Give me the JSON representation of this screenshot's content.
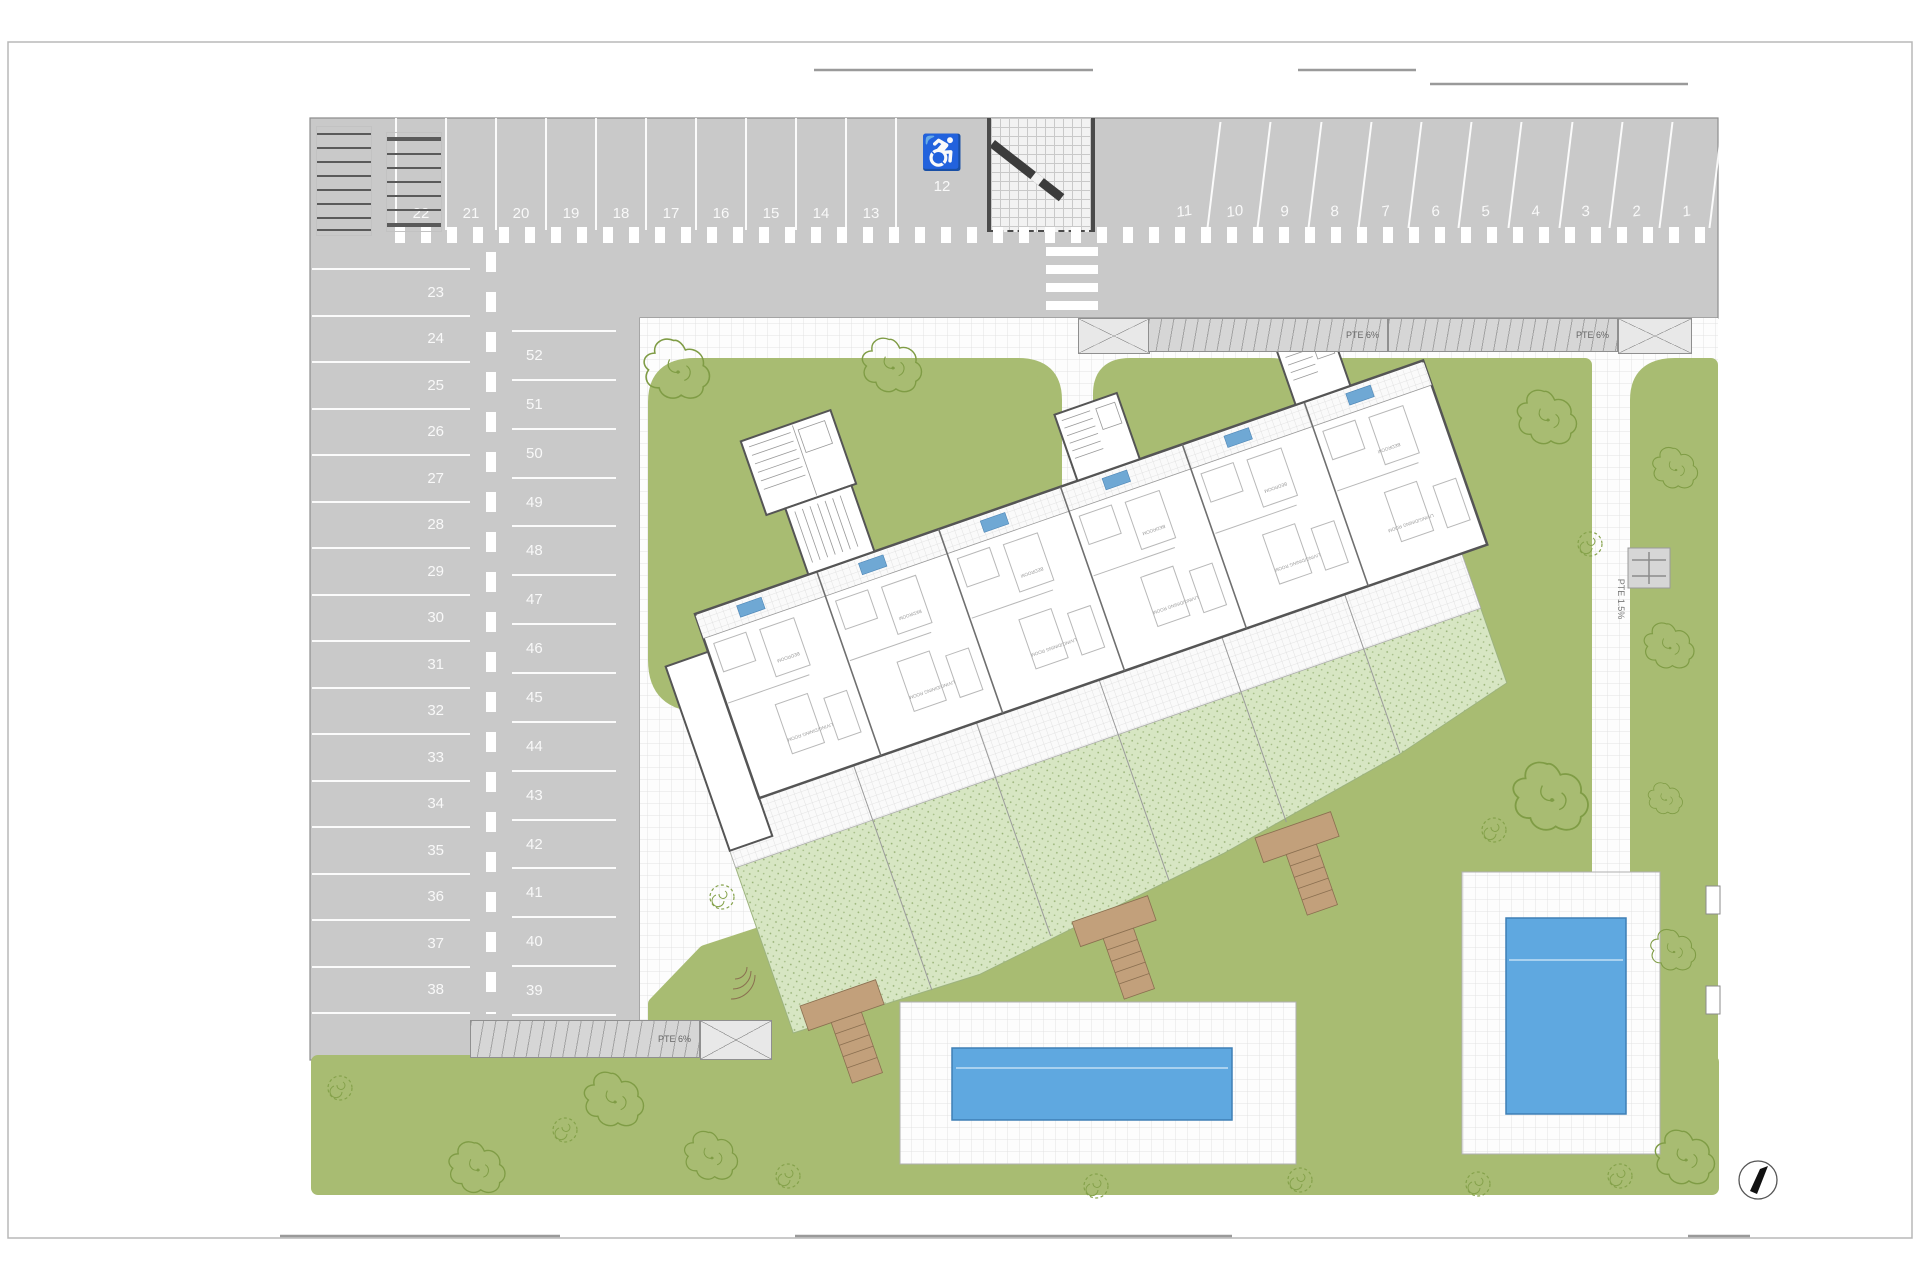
{
  "parking": {
    "rows": {
      "top_left": [
        "22",
        "21",
        "20",
        "19",
        "18",
        "17",
        "16",
        "15",
        "14",
        "13"
      ],
      "handicap": {
        "number": "12",
        "symbol": "♿"
      },
      "top_right": [
        "11",
        "10",
        "9",
        "8",
        "7",
        "6",
        "5",
        "4",
        "3",
        "2",
        "1"
      ],
      "left_column": [
        "23",
        "24",
        "25",
        "26",
        "27",
        "28",
        "29",
        "30",
        "31",
        "32",
        "33",
        "34",
        "35",
        "36",
        "37",
        "38"
      ],
      "middle_column": [
        "52",
        "51",
        "50",
        "49",
        "48",
        "47",
        "46",
        "45",
        "44",
        "43",
        "42",
        "41",
        "40",
        "39"
      ]
    }
  },
  "ramps": {
    "vehicle_slope_label": "PTE 6%",
    "path_slope_label": "PTE 1.5%"
  },
  "building": {
    "units": [
      {
        "bedroom_label": "BEDROOM",
        "living_label": "LIVING/DINING ROOM"
      },
      {
        "bedroom_label": "BEDROOM",
        "living_label": "LIVING/DINING ROOM"
      },
      {
        "bedroom_label": "BEDROOM",
        "living_label": "LIVING/DINING ROOM"
      },
      {
        "bedroom_label": "BEDROOM",
        "living_label": "LIVING/DINING ROOM"
      },
      {
        "bedroom_label": "BEDROOM",
        "living_label": "LIVING/DINING ROOM"
      },
      {
        "bedroom_label": "BEDROOM",
        "living_label": "LIVING/DINING ROOM"
      }
    ]
  },
  "colors": {
    "asphalt": "#c9c9c9",
    "lawn": "#a8bc72",
    "private_garden": "#d7e6c3",
    "pool_water": "#5fa8e0",
    "wood_walkway": "#c2a07b",
    "unit_badge": "#6fa8d4",
    "wall": "#555555"
  }
}
